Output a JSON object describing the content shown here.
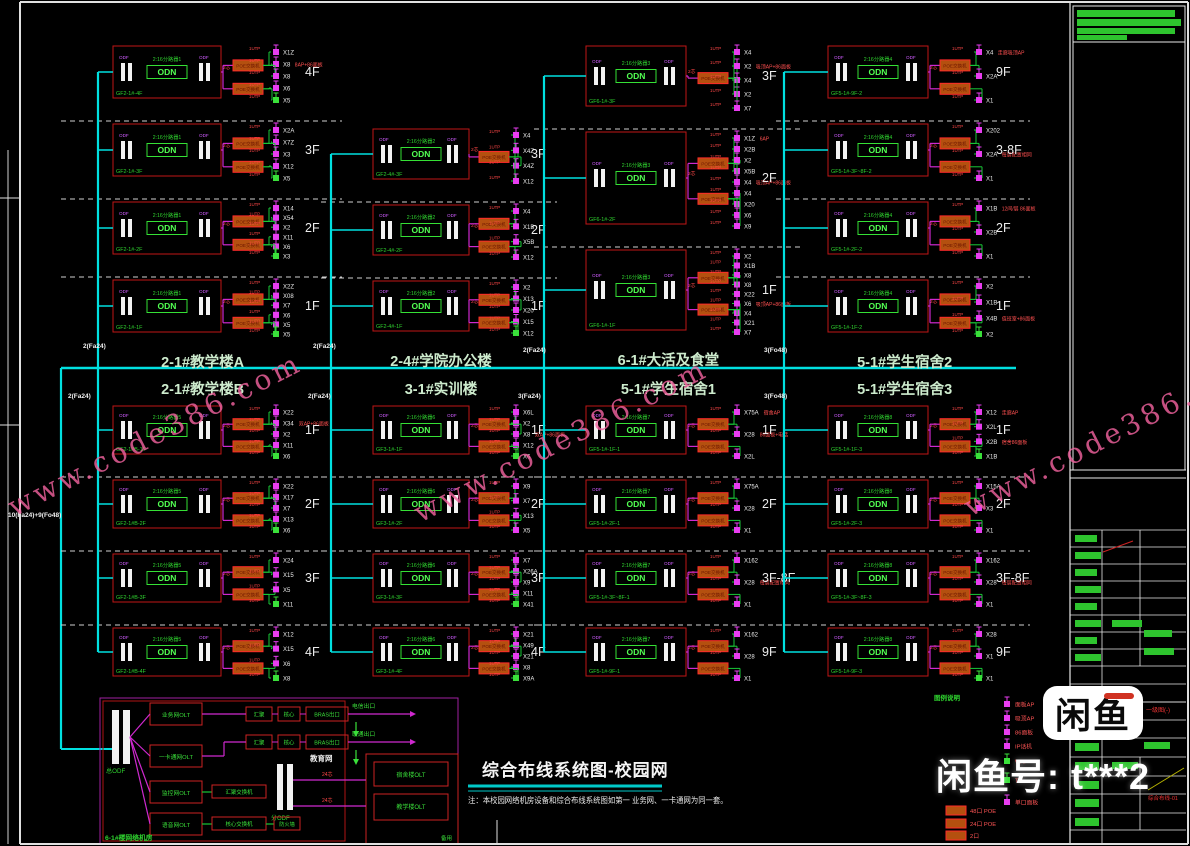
{
  "watermark": {
    "text": "www.code386.com"
  },
  "title": {
    "text": "综合布线系统图-校园网",
    "note": "注：本校园网络机房设备和综合布线系统图如第一 业务网、一卡通网为同一套。"
  },
  "seller": {
    "logo": "闲鱼",
    "account": "闲鱼号: t***2"
  },
  "labels": {
    "odn": "ODN",
    "panel": "ODF",
    "switch": "POE交换机",
    "fiber": "2芯",
    "utp": "1UTP"
  },
  "trunk_labels": [
    "2(Fa24)",
    "2(Fa24)",
    "2(Fa24)",
    "3(Fo48)",
    "2(Fa24)",
    "2(Fa24)",
    "3(Fa24)",
    "3(Fo48)",
    "10(Fa24)+9(Fo48)"
  ],
  "colors": {
    "trunk": "#00e0e0",
    "fiber_line": "#cf29cf",
    "utp_line": "#19c837",
    "block": "#c01616",
    "accent_green": "#2fd42f"
  },
  "buildings": [
    {
      "name": "2-1#教学楼A",
      "odn": "2:16分路器1",
      "floors": [
        {
          "f": "4F",
          "code": "GF2-1#-4F",
          "sw": 2,
          "aps": [
            [
              "X1Z"
            ],
            [
              "X8",
              "8AP+86面板"
            ],
            [
              "X8"
            ],
            [
              "X6"
            ],
            [
              "X5",
              "",
              "g"
            ]
          ]
        },
        {
          "f": "3F",
          "code": "GF2-1#-3F",
          "sw": 2,
          "aps": [
            [
              "X2A"
            ],
            [
              "X7Z"
            ],
            [
              "X3"
            ],
            [
              "X12"
            ],
            [
              "X5",
              "",
              "g"
            ]
          ]
        },
        {
          "f": "2F",
          "code": "GF2-1#-2F",
          "sw": 2,
          "aps": [
            [
              "X14"
            ],
            [
              "X54"
            ],
            [
              "X2"
            ],
            [
              "X11"
            ],
            [
              "X6"
            ],
            [
              "X3",
              "",
              "g"
            ]
          ]
        },
        {
          "f": "1F",
          "code": "GF2-1#-1F",
          "sw": 2,
          "aps": [
            [
              "X2Z"
            ],
            [
              "X08"
            ],
            [
              "X7"
            ],
            [
              "X6"
            ],
            [
              "X5"
            ],
            [
              "X5",
              "",
              "g"
            ]
          ]
        }
      ]
    },
    {
      "name": "2-4#学院办公楼",
      "odn": "2:16分路器2",
      "floors": [
        {
          "f": "3F",
          "code": "GF2-4#-3F",
          "sw": 1,
          "aps": [
            [
              "X4"
            ],
            [
              "X4Z"
            ],
            [
              "X4Z"
            ],
            [
              "X12"
            ]
          ]
        },
        {
          "f": "2F",
          "code": "GF2-4#-2F",
          "sw": 2,
          "aps": [
            [
              "X4"
            ],
            [
              "X1B"
            ],
            [
              "X5B"
            ],
            [
              "X12"
            ]
          ]
        },
        {
          "f": "1F",
          "code": "GF2-4#-1F",
          "sw": 2,
          "aps": [
            [
              "X2"
            ],
            [
              "X13"
            ],
            [
              "X20"
            ],
            [
              "X15"
            ],
            [
              "X12",
              "",
              "g"
            ]
          ]
        }
      ]
    },
    {
      "name": "6-1#大活及食堂",
      "odn": "2:16分路器3",
      "floors": [
        {
          "f": "3F",
          "code": "GF6-1#-3F",
          "sw": 1,
          "aps": [
            [
              "X4"
            ],
            [
              "X2",
              "吸顶AP+86面板"
            ],
            [
              "X4"
            ],
            [
              "X2"
            ],
            [
              "X7"
            ]
          ]
        },
        {
          "f": "2F",
          "code": "GF6-1#-2F",
          "sw": 2,
          "aps": [
            [
              "X1Z",
              "6AP"
            ],
            [
              "X2B"
            ],
            [
              "X2"
            ],
            [
              "X5B"
            ],
            [
              "X4",
              "吸顶AP+86面板"
            ],
            [
              "X4"
            ],
            [
              "X20"
            ],
            [
              "X6"
            ],
            [
              "X9"
            ]
          ]
        },
        {
          "f": "1F",
          "code": "GF6-1#-1F",
          "sw": 2,
          "aps": [
            [
              "X2"
            ],
            [
              "X1B"
            ],
            [
              "X8"
            ],
            [
              "X8"
            ],
            [
              "X22"
            ],
            [
              "X6",
              "吸顶AP+86面板"
            ],
            [
              "X4"
            ],
            [
              "X21"
            ],
            [
              "X7"
            ]
          ]
        }
      ]
    },
    {
      "name": "5-1#学生宿舍2",
      "odn": "2:16分路器4",
      "floors": [
        {
          "f": "9F",
          "code": "GF5-1#-9F-2",
          "sw": 2,
          "aps": [
            [
              "X4",
              "走廊吸顶AP"
            ],
            [
              "X2A"
            ],
            [
              "X1"
            ]
          ]
        },
        {
          "f": "3-8F",
          "code": "GF5-1#-3F~8F-2",
          "sw": 2,
          "aps": [
            [
              "X202"
            ],
            [
              "X2A",
              "每层配置相同"
            ],
            [
              "X1"
            ]
          ]
        },
        {
          "f": "2F",
          "code": "GF5-1#-2F-2",
          "sw": 2,
          "aps": [
            [
              "X1B",
              "12间/层 86面板"
            ],
            [
              "X2B"
            ],
            [
              "X1"
            ]
          ]
        },
        {
          "f": "1F",
          "code": "GF5-1#-1F-2",
          "sw": 2,
          "aps": [
            [
              "X2"
            ],
            [
              "X1B"
            ],
            [
              "X4B",
              "值班室+86面板"
            ],
            [
              "X2",
              "",
              "g"
            ]
          ]
        }
      ]
    },
    {
      "name": "2-1#教学楼B",
      "odn": "2:16分路器5",
      "floors": [
        {
          "f": "1F",
          "code": "GF2-1#B-1F",
          "sw": 2,
          "aps": [
            [
              "X22"
            ],
            [
              "X34",
              "双AP+86面板"
            ],
            [
              "X2"
            ],
            [
              "X11"
            ],
            [
              "X6",
              "",
              "g"
            ]
          ]
        },
        {
          "f": "2F",
          "code": "GF2-1#B-2F",
          "sw": 2,
          "aps": [
            [
              "X22"
            ],
            [
              "X17"
            ],
            [
              "X7"
            ],
            [
              "X13"
            ],
            [
              "X6",
              "",
              "g"
            ]
          ]
        },
        {
          "f": "3F",
          "code": "GF2-1#B-3F",
          "sw": 2,
          "aps": [
            [
              "X24"
            ],
            [
              "X15"
            ],
            [
              "X5"
            ],
            [
              "X11",
              "",
              "g"
            ]
          ]
        },
        {
          "f": "4F",
          "code": "GF2-1#B-4F",
          "sw": 2,
          "aps": [
            [
              "X12"
            ],
            [
              "X15"
            ],
            [
              "X6"
            ],
            [
              "X8",
              "",
              "g"
            ]
          ]
        }
      ]
    },
    {
      "name": "3-1#实训楼",
      "odn": "2:16分路器6",
      "floors": [
        {
          "f": "1F",
          "code": "GF3-1#-1F",
          "sw": 2,
          "aps": [
            [
              "X6L"
            ],
            [
              "X2"
            ],
            [
              "X8",
              "双AP+86面板"
            ],
            [
              "X12"
            ],
            [
              "X6",
              "",
              "g"
            ]
          ]
        },
        {
          "f": "2F",
          "code": "GF3-1#-2F",
          "sw": 2,
          "aps": [
            [
              "X9"
            ],
            [
              "X7"
            ],
            [
              "X13"
            ],
            [
              "X5"
            ]
          ]
        },
        {
          "f": "3F",
          "code": "GF3-1#-3F",
          "sw": 2,
          "aps": [
            [
              "X7"
            ],
            [
              "X26A"
            ],
            [
              "X9"
            ],
            [
              "X11"
            ],
            [
              "X41",
              "",
              "g"
            ]
          ]
        },
        {
          "f": "4F",
          "code": "GF3-1#-4F",
          "sw": 2,
          "aps": [
            [
              "X21"
            ],
            [
              "X49"
            ],
            [
              "X21"
            ],
            [
              "X8"
            ],
            [
              "X9A",
              "",
              "g"
            ]
          ]
        }
      ]
    },
    {
      "name": "5-1#学生宿舍1",
      "odn": "2:16分路器7",
      "floors": [
        {
          "f": "1F",
          "code": "GF5-1#-1F-1",
          "sw": 2,
          "aps": [
            [
              "X75A",
              "宿舍AP"
            ],
            [
              "X28",
              "86面板+电话"
            ],
            [
              "X2L"
            ]
          ]
        },
        {
          "f": "2F",
          "code": "GF5-1#-2F-1",
          "sw": 2,
          "aps": [
            [
              "X75A"
            ],
            [
              "X28"
            ],
            [
              "X1"
            ]
          ]
        },
        {
          "f": "3F-8F",
          "code": "GF5-1#-3F~8F-1",
          "sw": 2,
          "aps": [
            [
              "X162"
            ],
            [
              "X28",
              "每层配置相同"
            ],
            [
              "X1"
            ]
          ]
        },
        {
          "f": "9F",
          "code": "GF5-1#-9F-1",
          "sw": 2,
          "aps": [
            [
              "X162"
            ],
            [
              "X28"
            ],
            [
              "X1"
            ]
          ]
        }
      ]
    },
    {
      "name": "5-1#学生宿舍3",
      "odn": "2:16分路器8",
      "floors": [
        {
          "f": "1F",
          "code": "GF5-1#-1F-3",
          "sw": 2,
          "aps": [
            [
              "X12",
              "走廊AP"
            ],
            [
              "X2L"
            ],
            [
              "X2B",
              "宿舍86面板"
            ],
            [
              "X1B",
              "",
              "g"
            ]
          ]
        },
        {
          "f": "2F",
          "code": "GF5-1#-2F-3",
          "sw": 2,
          "aps": [
            [
              "X15A"
            ],
            [
              "X3"
            ],
            [
              "X1"
            ]
          ]
        },
        {
          "f": "3F-8F",
          "code": "GF5-1#-3F~8F-3",
          "sw": 2,
          "aps": [
            [
              "X162"
            ],
            [
              "X28",
              "每层配置相同"
            ],
            [
              "X1"
            ]
          ]
        },
        {
          "f": "9F",
          "code": "GF5-1#-9F-3",
          "sw": 2,
          "aps": [
            [
              "X28"
            ],
            [
              "X1"
            ],
            [
              "X1",
              "",
              "g"
            ]
          ]
        }
      ]
    }
  ],
  "machine_room": {
    "room_label": "6-1#楼网络机房",
    "odf_main": "总ODF",
    "odf_sub": "分ODF",
    "olts": [
      "业务网OLT",
      "一卡通网OLT",
      "监控网OLT",
      "语音网OLT"
    ],
    "chains": [
      {
        "boxes": [
          "汇聚",
          "核心",
          "BRAS出口"
        ],
        "exit": "电信出口"
      },
      {
        "boxes": [
          "汇聚",
          "核心",
          "BRAS出口"
        ],
        "exit": "联通出口"
      }
    ],
    "edu_label": "教育网",
    "agg_box": "汇聚交换机",
    "core_box": "核心交换机",
    "fw_box": "防火墙",
    "remote_olts": [
      "宿舍楼OLT",
      "教学楼OLT"
    ],
    "fiber_labels": [
      "24芯",
      "24芯"
    ],
    "spare_label": "备用"
  },
  "legend": {
    "title": "图例说明",
    "devices": [
      {
        "label": "面板AP",
        "color": "m"
      },
      {
        "label": "吸顶AP",
        "color": "m"
      },
      {
        "label": "86面板",
        "color": "m"
      },
      {
        "label": "IP话机",
        "color": "m"
      },
      {
        "label": "WAP",
        "color": "g"
      },
      {
        "label": "TV",
        "color": "g"
      },
      {
        "label": "单口面板",
        "color": "m"
      }
    ],
    "switches": [
      "48口 POE",
      "24口 POE",
      "2口"
    ]
  },
  "titleblock": {
    "stage_label": "一级图(-)",
    "drawing_no": "综合布线-01"
  }
}
